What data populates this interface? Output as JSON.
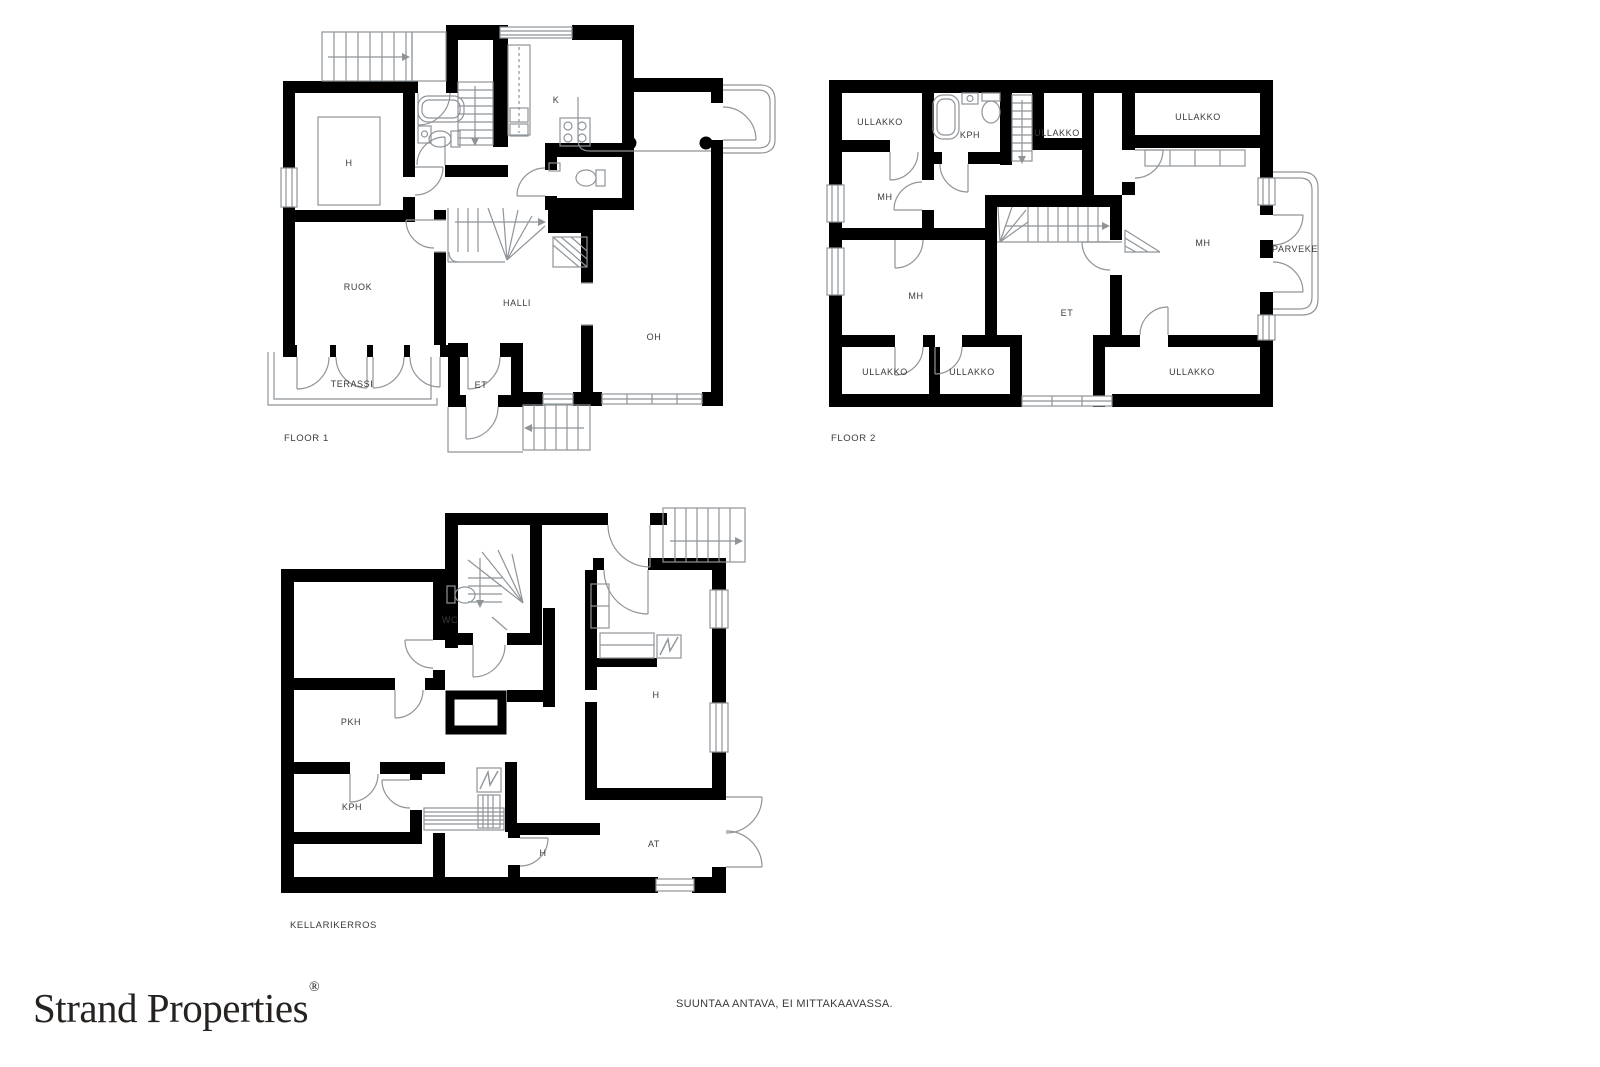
{
  "branding": {
    "name": "Strand Properties",
    "registered_mark": "®"
  },
  "footer": {
    "disclaimer": "SUUNTAA ANTAVA, EI MITTAKAAVASSA."
  },
  "colors": {
    "wall": "#000000",
    "thin_line": "#8f9499",
    "label_text": "#3a3a3a",
    "background": "#ffffff"
  },
  "plans": [
    {
      "id": "floor1",
      "caption": "FLOOR 1",
      "caption_pos": {
        "x": 284,
        "y": 433
      },
      "rooms": [
        {
          "label": "H",
          "x": 349,
          "y": 163
        },
        {
          "label": "K",
          "x": 556,
          "y": 100
        },
        {
          "label": "RUOK",
          "x": 358,
          "y": 287
        },
        {
          "label": "HALLI",
          "x": 517,
          "y": 303
        },
        {
          "label": "OH",
          "x": 654,
          "y": 337
        },
        {
          "label": "TERASSI",
          "x": 352,
          "y": 384
        },
        {
          "label": "ET",
          "x": 481,
          "y": 385
        }
      ]
    },
    {
      "id": "floor2",
      "caption": "FLOOR 2",
      "caption_pos": {
        "x": 831,
        "y": 433
      },
      "rooms": [
        {
          "label": "ULLAKKO",
          "x": 880,
          "y": 122
        },
        {
          "label": "KPH",
          "x": 970,
          "y": 135
        },
        {
          "label": "ULLAKKO",
          "x": 1057,
          "y": 133
        },
        {
          "label": "ULLAKKO",
          "x": 1198,
          "y": 117
        },
        {
          "label": "MH",
          "x": 885,
          "y": 197
        },
        {
          "label": "MH",
          "x": 1203,
          "y": 243
        },
        {
          "label": "PARVEKE",
          "x": 1295,
          "y": 249
        },
        {
          "label": "MH",
          "x": 916,
          "y": 296
        },
        {
          "label": "ET",
          "x": 1067,
          "y": 313
        },
        {
          "label": "ULLAKKO",
          "x": 885,
          "y": 372
        },
        {
          "label": "ULLAKKO",
          "x": 972,
          "y": 372
        },
        {
          "label": "ULLAKKO",
          "x": 1192,
          "y": 372
        }
      ]
    },
    {
      "id": "kellarikerros",
      "caption": "KELLARIKERROS",
      "caption_pos": {
        "x": 290,
        "y": 920
      },
      "rooms": [
        {
          "label": "WC",
          "x": 450,
          "y": 620
        },
        {
          "label": "H",
          "x": 656,
          "y": 695
        },
        {
          "label": "PKH",
          "x": 351,
          "y": 722
        },
        {
          "label": "KPH",
          "x": 352,
          "y": 807
        },
        {
          "label": "H",
          "x": 543,
          "y": 853
        },
        {
          "label": "AT",
          "x": 654,
          "y": 844
        }
      ]
    }
  ]
}
